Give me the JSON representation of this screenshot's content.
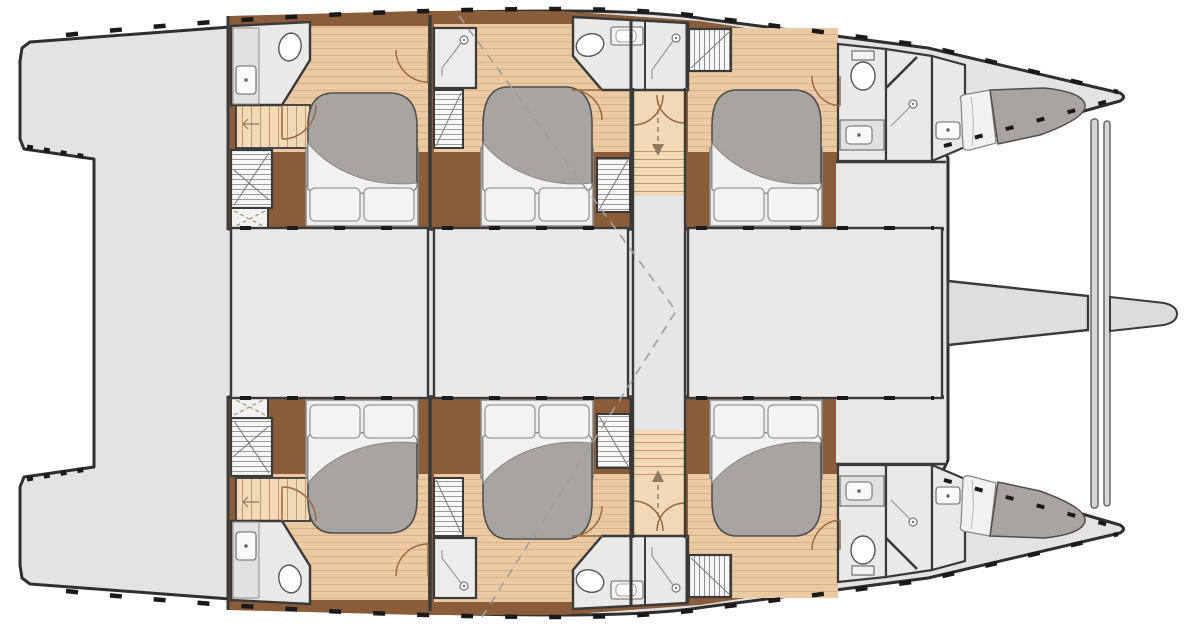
{
  "document": {
    "type": "yacht-deck-plan",
    "subject": "sailing catamaran interior layout, top-down view",
    "visible_text": "none",
    "orientation": "bow to the right, stern platforms to the left, mirrored about horizontal centerline"
  },
  "layout": {
    "hulls": 2,
    "cabins_total": 6,
    "cabins_per_hull": 3,
    "cabin_features": [
      "double-bed",
      "gray-duvet",
      "two-pillows",
      "wood-plank-floor",
      "wardrobe",
      "door-swing"
    ],
    "aft_cabin_extras": [
      "en-suite-bathroom-with-toilet-and-sink",
      "companion-steps",
      "deck-hatch"
    ],
    "mid_cabin_extras": [
      "shower-cubicle",
      "shared-head-with-toilet-sink-shower",
      "two-wardrobes"
    ],
    "fwd_cabin_extras": [
      "hanging-wardrobe",
      "bow-bathroom-toilet-sink-shower",
      "forepeak-berth"
    ],
    "saloon_blocks": 3,
    "companionway": {
      "position": "between mid and forward cabins",
      "top_arrow": "down",
      "bottom_arrow": "up"
    },
    "bow_structure": [
      "trampoline-openings",
      "forward-beam",
      "double-crossbeam",
      "bowsprit"
    ],
    "stern_structure": [
      "twin-transom-steps",
      "aft-deck"
    ]
  },
  "legend_icons": [
    "toilet-icon",
    "sink-icon",
    "shower-head-icon",
    "stair-treads",
    "door-swing-arc",
    "direction-arrow",
    "hatch-cross"
  ],
  "colors": {
    "background": "#ffffff",
    "deck_gray": "#e3e3e3",
    "saloon_gray": "#e9e9e9",
    "outline_dark": "#2f2f2f",
    "wood_floor": "#ebc9a2",
    "wood_line": "#dab287",
    "stair_tan": "#f1d8b6",
    "furniture_brown": "#8b5c39",
    "duvet_gray": "#a7a4a2",
    "linen_white": "#f1f1f1",
    "door_arc_brown": "#9a6a42",
    "dash_gray": "#9e9e9e"
  }
}
